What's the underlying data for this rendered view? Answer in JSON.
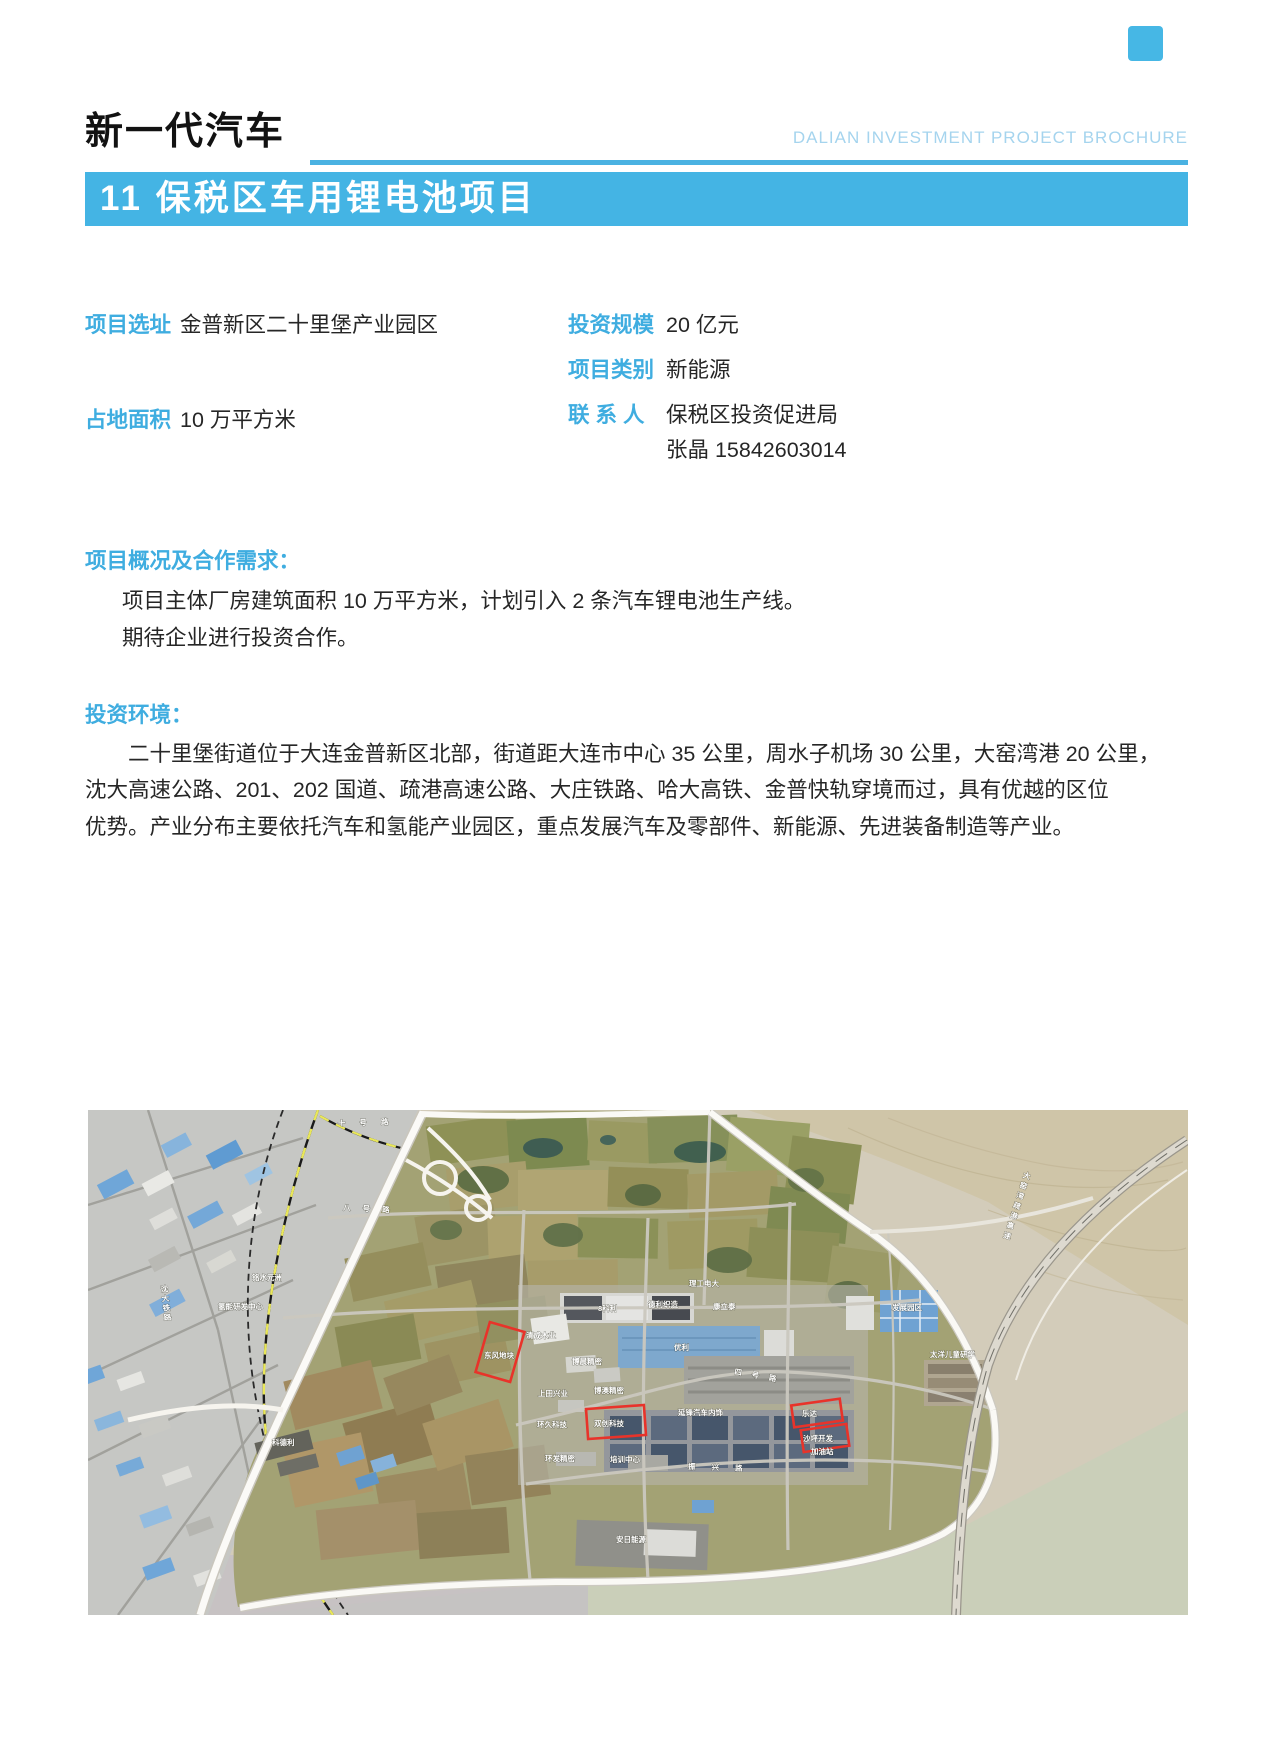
{
  "header": {
    "category_title": "新一代汽车",
    "brochure_title": "DALIAN INVESTMENT PROJECT BROCHURE",
    "banner": "11 保税区车用锂电池项目"
  },
  "fields": {
    "site": {
      "label": "项目选址",
      "value": "金普新区二十里堡产业园区"
    },
    "area": {
      "label": "占地面积",
      "value": "10 万平方米"
    },
    "investment": {
      "label": "投资规模",
      "value": "20 亿元"
    },
    "category": {
      "label": "项目类别",
      "value": "新能源"
    },
    "contact": {
      "label": "联 系 人",
      "value": "保税区投资促进局",
      "value2": "张晶 15842603014"
    }
  },
  "overview": {
    "heading": "项目概况及合作需求：",
    "lines": [
      "项目主体厂房建筑面积 10 万平方米，计划引入 2 条汽车锂电池生产线。",
      "期待企业进行投资合作。"
    ]
  },
  "environment": {
    "heading": "投资环境：",
    "lines": [
      "二十里堡街道位于大连金普新区北部，街道距大连市中心 35 公里，周水子机场 30 公里，大窑湾港 20 公里，",
      "沈大高速公路、201、202 国道、疏港高速公路、大庄铁路、哈大高铁、金普快轨穿境而过，具有优越的区位",
      "优势。产业分布主要依托汽车和氢能产业园区，重点发展汽车及零部件、新能源、先进装备制造等产业。"
    ]
  },
  "colors": {
    "accent": "#44b4e4",
    "accent_text": "#3fade0",
    "light_blue": "#a5d4ee",
    "underline_blue": "#4ab2e2",
    "highlight_red": "#e8332a",
    "body_text": "#262626"
  },
  "map": {
    "labels": [
      {
        "t": "十号路",
        "x": 250,
        "y": 16,
        "ls": 14,
        "r": -2
      },
      {
        "t": "八号路",
        "x": 255,
        "y": 100,
        "ls": 12,
        "r": 3
      },
      {
        "t": "铭水元洲",
        "x": 164,
        "y": 170
      },
      {
        "t": "氢能研发中心",
        "x": 130,
        "y": 199
      },
      {
        "t": "理工电大",
        "x": 601,
        "y": 176
      },
      {
        "t": "8科利",
        "x": 510,
        "y": 201
      },
      {
        "t": "德利织造",
        "x": 560,
        "y": 197
      },
      {
        "t": "康立泰",
        "x": 625,
        "y": 199
      },
      {
        "t": "清成木业",
        "x": 438,
        "y": 228
      },
      {
        "t": "东风地块",
        "x": 396,
        "y": 248
      },
      {
        "t": "优利",
        "x": 586,
        "y": 240
      },
      {
        "t": "博晨精密",
        "x": 484,
        "y": 254
      },
      {
        "t": "发展园区",
        "x": 804,
        "y": 200
      },
      {
        "t": "太洋儿童研学",
        "x": 842,
        "y": 247
      },
      {
        "t": "上田兴业",
        "x": 450,
        "y": 286
      },
      {
        "t": "博澳精密",
        "x": 506,
        "y": 283
      },
      {
        "t": "环久科技",
        "x": 449,
        "y": 317
      },
      {
        "t": "双创科技",
        "x": 506,
        "y": 316
      },
      {
        "t": "延锋汽车内饰",
        "x": 590,
        "y": 305
      },
      {
        "t": "四号路",
        "x": 646,
        "y": 264,
        "ls": 10,
        "r": 10
      },
      {
        "t": "环发精密",
        "x": 457,
        "y": 351
      },
      {
        "t": "培训中心",
        "x": 522,
        "y": 352
      },
      {
        "t": "乐达",
        "x": 714,
        "y": 306
      },
      {
        "t": "沙坪开发",
        "x": 715,
        "y": 331
      },
      {
        "t": "加油站",
        "x": 723,
        "y": 344
      },
      {
        "t": "振兴路",
        "x": 600,
        "y": 359,
        "ls": 16,
        "r": 2
      },
      {
        "t": "科德利",
        "x": 184,
        "y": 335
      },
      {
        "t": "安日能源",
        "x": 528,
        "y": 432
      },
      {
        "t": "大窑湾疏港高速",
        "x": 940,
        "y": 62,
        "vert": true,
        "r": 18,
        "ls": 3
      },
      {
        "t": "沈大铁路",
        "x": 76,
        "y": 175,
        "vert": true,
        "r": -6,
        "ls": 2
      }
    ],
    "highlights": [
      {
        "cx": 412,
        "cy": 242,
        "w": 36,
        "h": 52,
        "rot": 16
      },
      {
        "cx": 528,
        "cy": 312,
        "w": 58,
        "h": 30,
        "rot": -4
      },
      {
        "cx": 729,
        "cy": 303,
        "w": 49,
        "h": 22,
        "rot": -8
      },
      {
        "cx": 737,
        "cy": 328,
        "w": 46,
        "h": 22,
        "rot": -8
      }
    ]
  }
}
